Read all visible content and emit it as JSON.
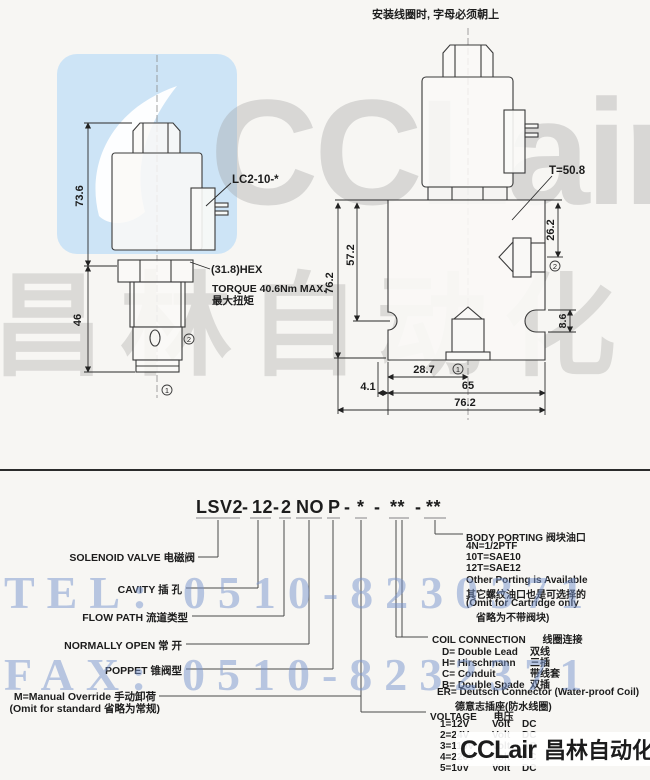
{
  "top_note": "安装线圈时, 字母必须朝上",
  "side_view": {
    "lc_label": "LC2-10-*",
    "hex_label": "(31.8)HEX",
    "torque1": "TORQUE 40.6Nm MAX.",
    "torque2": "最大扭矩",
    "dim_h1": "73.6",
    "dim_h2": "46",
    "port1": "1",
    "port2": "2"
  },
  "front_view": {
    "t_label": "T=50.8",
    "dim_total": "76.2",
    "dim_mid": "57.2",
    "dim_port2": "26.2",
    "dim_slot": "8.6",
    "dim_287": "28.7",
    "dim_41": "4.1",
    "dim_65": "65",
    "dim_width": "76.2",
    "port1": "1",
    "port2": "2"
  },
  "code": {
    "segments": [
      "LSV2",
      "-",
      "12",
      "-",
      "2",
      "NO",
      "P",
      "-",
      "*",
      "-",
      "**",
      "-",
      "**"
    ]
  },
  "left_labels": [
    "SOLENOID VALVE  电磁阀",
    "CAVITY  插 孔",
    "FLOW PATH  流道类型",
    "NORMALLY OPEN  常 开",
    "POPPET  锥阀型"
  ],
  "manual": {
    "line1": "M=Manual Override  手动卸荷",
    "line2": "(Omit for standard  省略为常规)"
  },
  "body_porting": {
    "title": "BODY PORTING 阀块油口",
    "lines": [
      "4N=1/2PTF",
      "10T=SAE10",
      "12T=SAE12",
      "Other Porting is Available",
      "其它螺纹油口也是可选择的",
      "(Omit for Cartridge only",
      "省略为不带阀块)"
    ]
  },
  "coil": {
    "title_en": "COIL CONNECTION",
    "title_zh": "线圈连接",
    "options": [
      {
        "name": "D= Double Lead",
        "zh": "双线"
      },
      {
        "name": "H= Hirschmann",
        "zh": "三插"
      },
      {
        "name": "C= Conduit",
        "zh": "带线套"
      },
      {
        "name": "B= Double Spade",
        "zh": "双插"
      }
    ],
    "er": "ER= Deutsch Connector (Water-proof Coil)",
    "er_zh": "德意志插座(防水线圈)"
  },
  "voltage": {
    "title_en": "VOLTAGE",
    "title_zh": "电压",
    "rows": [
      {
        "code": "1=12V",
        "volt": "Volt",
        "type": "DC"
      },
      {
        "code": "2=24V",
        "volt": "Volt",
        "type": "DC"
      },
      {
        "code": "3=110V",
        "volt": "Volt",
        "type": "AC"
      },
      {
        "code": "4=220V",
        "volt": "Volt",
        "type": "AC"
      },
      {
        "code": "5=10V",
        "volt": "Volt",
        "type": "DC"
      }
    ]
  },
  "watermarks": {
    "brand": "CCLair",
    "brand_cn": "昌林自动化",
    "tel": "TEL: 0510-8230371",
    "fax": "FAX: 0510-8232371"
  },
  "logo": {
    "brand": "CCLair",
    "cn": "昌林自动化"
  }
}
